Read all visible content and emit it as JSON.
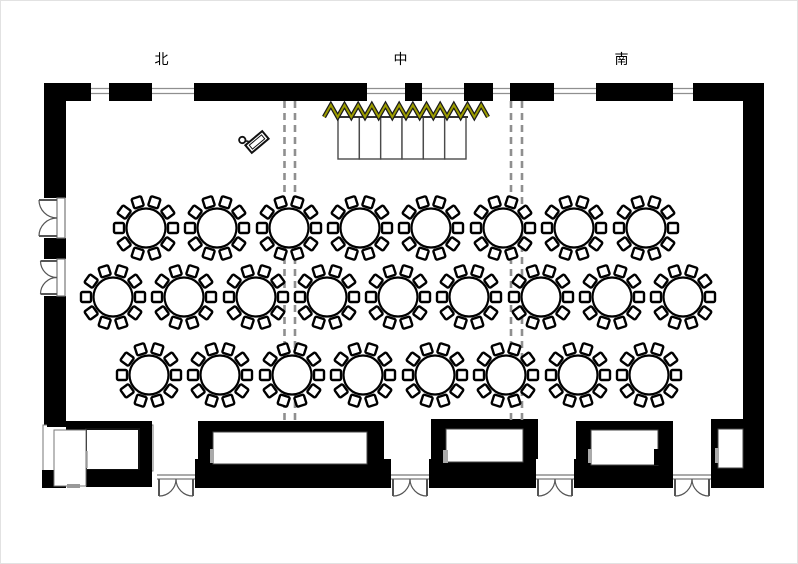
{
  "section_labels": {
    "north": "北",
    "center": "中",
    "south": "南"
  },
  "colors": {
    "wall": "#000000",
    "floor": "#ffffff",
    "zigzag": "#9c9c00",
    "partition_dash": "#8f8f8f",
    "window_line": "#8f8f8f",
    "door_line": "#555555",
    "opening_gray": "#aaaaaa"
  },
  "plan": {
    "dining_tables": {
      "seats_per_table": 10,
      "total_tables": 25,
      "table_radius": 19.5,
      "chair_size": 10,
      "chair_offset": 27,
      "rows": [
        {
          "name": "row-1",
          "y": 227,
          "x": [
            145,
            216,
            288,
            359,
            430,
            502,
            573,
            645
          ]
        },
        {
          "name": "row-2",
          "y": 296,
          "x": [
            112,
            183,
            255,
            326,
            397,
            468,
            540,
            611,
            682
          ]
        },
        {
          "name": "row-3",
          "y": 374,
          "x": [
            148,
            219,
            291,
            362,
            434,
            505,
            577,
            648
          ]
        }
      ]
    },
    "head_table": {
      "x": 337,
      "y": 116,
      "width": 128,
      "height": 42,
      "cells": 6
    },
    "zigzag_screen": {
      "x1": 323,
      "x2": 487,
      "y_base": 116,
      "amplitude": 12,
      "peaks": 12
    },
    "partition_lines": {
      "x_positions": [
        283.5,
        294,
        510,
        521
      ],
      "y1": 100,
      "y2": 419
    },
    "lectern": {
      "x": 256,
      "y": 141,
      "rotation": -40
    },
    "doors": {
      "bottom": [
        {
          "x": 156,
          "width": 38
        },
        {
          "x": 390,
          "width": 38
        },
        {
          "x": 535,
          "width": 38
        },
        {
          "x": 672,
          "width": 38
        }
      ],
      "left": [
        {
          "y": 197,
          "height": 40
        },
        {
          "y": 258,
          "height": 37
        }
      ]
    }
  }
}
